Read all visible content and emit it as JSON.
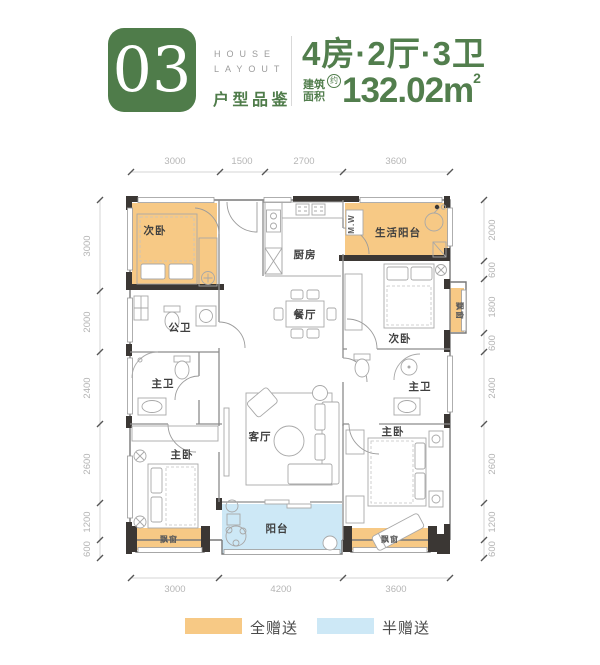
{
  "header": {
    "number": "03",
    "tagline_line1": "HOUSE",
    "tagline_line2": "LAYOUT",
    "subtitle": "户型品鉴",
    "title": "4房·2厅·3卫",
    "area_label_top": "建筑",
    "area_label_bottom": "面积",
    "area_approx": "约",
    "area_value": "132.02m",
    "area_exponent": "2"
  },
  "dimensions": {
    "top": [
      "3000",
      "1500",
      "2700",
      "3600"
    ],
    "bottom": [
      "3000",
      "4200",
      "3600"
    ],
    "left": [
      "3000",
      "2000",
      "2400",
      "2600",
      "1200",
      "600"
    ],
    "right": [
      "2000",
      "600",
      "1800",
      "600",
      "2400",
      "2600",
      "1200",
      "600"
    ]
  },
  "rooms": {
    "bedroom_top_left": "次卧",
    "kitchen": "厨房",
    "life_balcony": "生活阳台",
    "washer": "M.W",
    "bedroom_right": "次卧",
    "bay_window_right": "飘窗",
    "public_bath": "公卫",
    "dining": "餐厅",
    "master_bath_left": "主卫",
    "master_bath_right": "主卫",
    "master_bedroom_left": "主卧",
    "master_bedroom_right": "主卧",
    "living": "客厅",
    "balcony": "阳台",
    "bay_window_bottom_left": "飘窗",
    "bay_window_bottom_right": "飘窗"
  },
  "legend": {
    "full_gift": {
      "label": "全赠送",
      "color": "#F7C985"
    },
    "half_gift": {
      "label": "半赠送",
      "color": "#CDE8F6"
    }
  },
  "colors": {
    "brand_green": "#4F7C4A",
    "full_gift_fill": "#F7C985",
    "half_gift_fill": "#CDE8F6",
    "wall_black": "#3B3734"
  }
}
